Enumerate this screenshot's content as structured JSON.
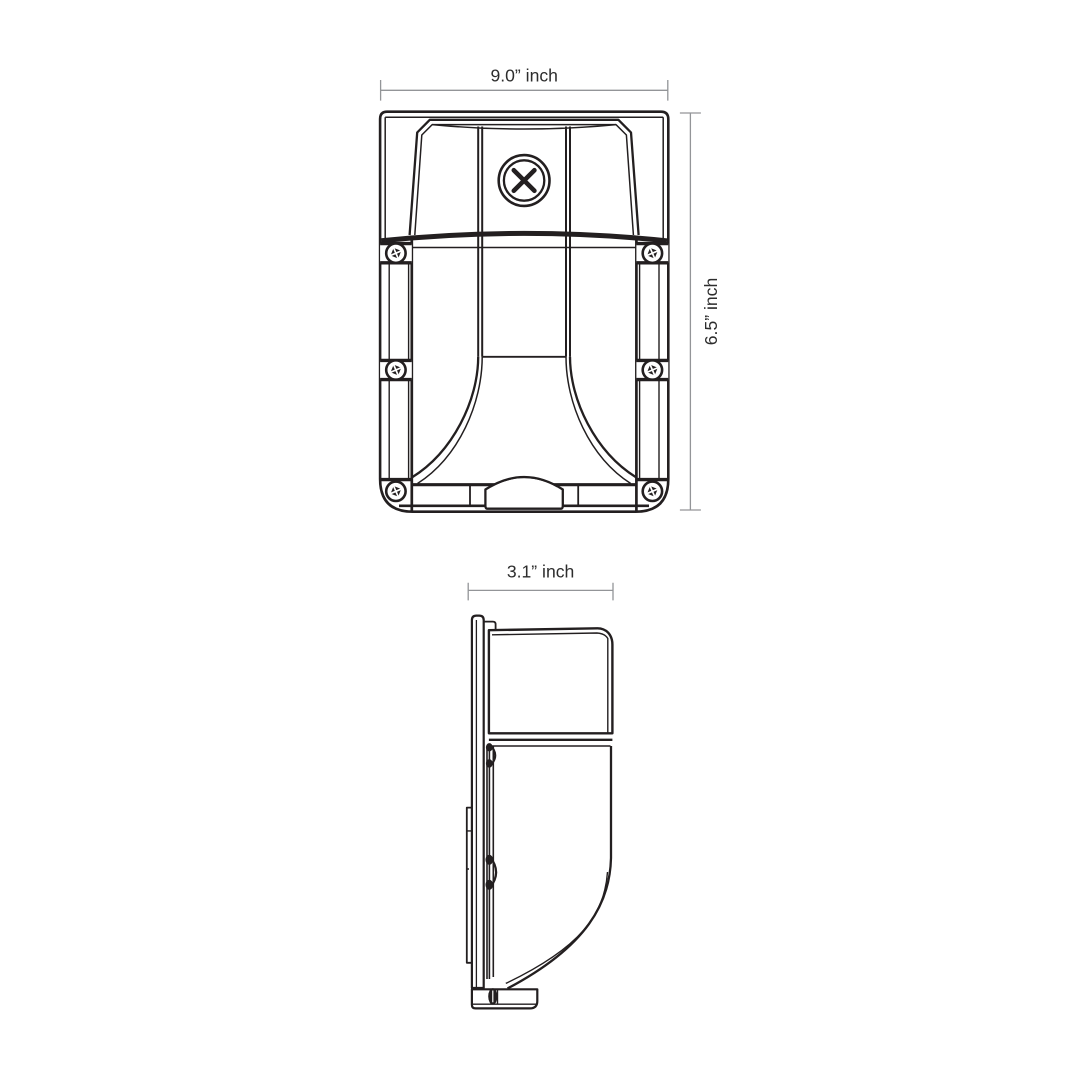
{
  "drawing": {
    "front_view": {
      "width_dimension": "9.0” inch",
      "height_dimension": "6.5” inch"
    },
    "side_view": {
      "depth_dimension": "3.1” inch"
    },
    "colors": {
      "line": "#231f20",
      "dimension_line": "#939598",
      "label_text": "#2d2d2d",
      "background": "#ffffff"
    }
  }
}
